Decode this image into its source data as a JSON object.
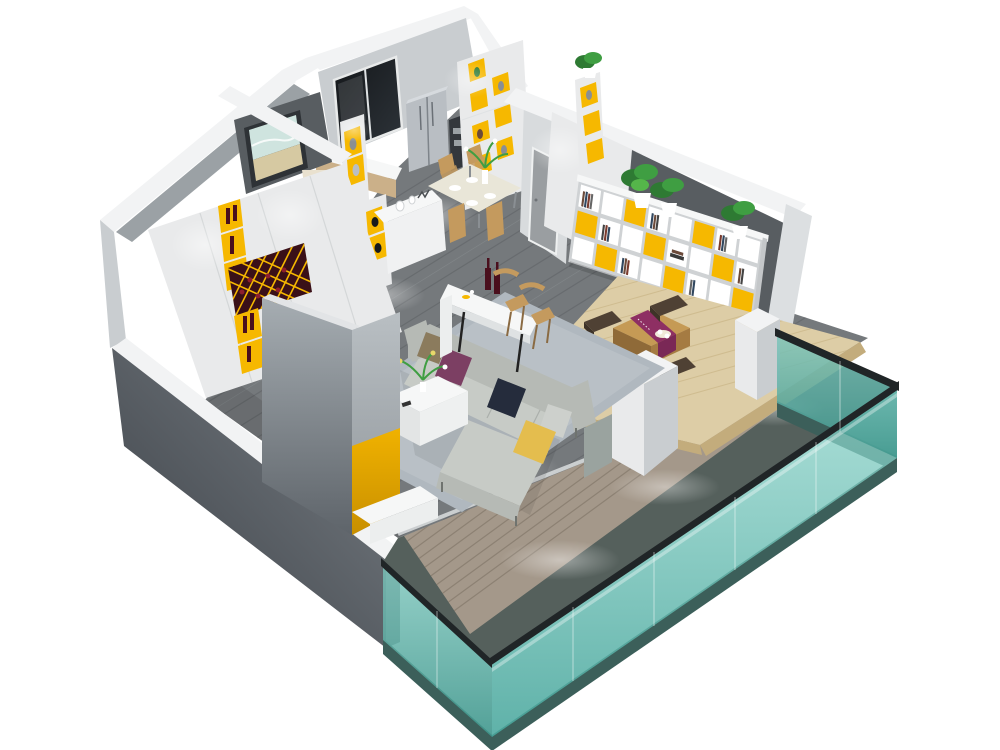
{
  "scene": {
    "description": "isometric-3d-cutaway-render-of-modern-apartment",
    "background": "#ffffff",
    "rooms": [
      {
        "name": "kitchen",
        "items": [
          "dark-glass-window",
          "double-door-refrigerator",
          "oven-column",
          "counter-with-sink",
          "tall-shelf-unit-yellow-niches",
          "display-column-with-plant"
        ]
      },
      {
        "name": "dining-area",
        "items": [
          "dining-table",
          "four-tan-chairs",
          "flower-vase",
          "place-settings"
        ]
      },
      {
        "name": "entry-hall",
        "items": [
          "dark-accent-wall",
          "seascape-wall-art",
          "table-lamp",
          "sideboard-with-wine-slots",
          "display-niche-columns",
          "lit-bottle-shelf",
          "decor-console",
          "hallway-door"
        ]
      },
      {
        "name": "wine-wall",
        "items": [
          "white-panel-cabinet",
          "yellow-bottle-niches",
          "diamond-lattice-wine-rack",
          "spotlights"
        ]
      },
      {
        "name": "living-room",
        "items": [
          "gray-plank-floor",
          "area-rug",
          "l-shaped-sectional-sofa",
          "five-throw-pillows",
          "coffee-table-with-bouquet",
          "tv-partition-wall-yellow-stripe",
          "tv-cabinet",
          "bar-counter",
          "two-bar-stools",
          "two-wine-bottles"
        ]
      },
      {
        "name": "tatami-lounge",
        "items": [
          "raised-wood-platform",
          "low-tea-table",
          "purple-table-runner",
          "four-floor-cushions",
          "tea-set",
          "wall-bookshelf-yellow-panels",
          "three-potted-plants",
          "dark-accent-wall"
        ]
      },
      {
        "name": "balcony",
        "items": [
          "wood-plank-deck",
          "teal-glass-railing",
          "dark-top-rail",
          "stone-base",
          "knee-wall-piers"
        ]
      }
    ],
    "pillow_colors": [
      "taupe",
      "purple",
      "navy",
      "yellow",
      "light-gray"
    ],
    "accent_color_name": "yellow",
    "railing_material": "teal-glass"
  },
  "palette": {
    "bg": "#ffffff",
    "band": "#f2f3f4",
    "white": "#f6f7f7",
    "wallLight": "#e9eaeb",
    "wallMid": "#c9cdd0",
    "wallGray": "#9ba1a5",
    "wallDark": "#585d61",
    "floor": "#75797c",
    "floorLine": "#5d6164",
    "floorLight": "#8b9093",
    "deck": "#a4988a",
    "deckLine": "#7e7264",
    "deckDark": "#55605c",
    "stone": "#3c5f5a",
    "glass": "#7ac9bf",
    "glassDeep": "#3f9a90",
    "rail": "#202527",
    "platform": "#ddcda6",
    "platformEdge": "#c3ac7c",
    "platformLine": "#c9b587",
    "yellow": "#f6b800",
    "yellowDeep": "#c88f00",
    "maroon": "#3a1018",
    "rug": "#b0b8bf",
    "sofa": "#b6bab5",
    "sofaLight": "#c7cbc6",
    "sofaDark": "#979d98",
    "pillowBrown": "#8b7b5d",
    "pillowPurple": "#7c3f63",
    "pillowNavy": "#252c3c",
    "pillowYellow": "#e4bd4e",
    "pillowGray": "#cdd0cc",
    "cushion": "#4f4134",
    "tableWood": "#c59a55",
    "tableWoodDark": "#8f6a38",
    "tableWoodMid": "#a57b42",
    "runner": "#8e2f63",
    "runnerDark": "#7a2856",
    "chairTan": "#c49a5e",
    "bottle": "#4a0f1d",
    "steel": "#b9bec3",
    "doorGray": "#c4c8ca",
    "paintTeal": "#cfe4df",
    "paintSand": "#d6c9a2",
    "lampShade": "#e9e1cf",
    "plant": "#3f9e42",
    "plantDark": "#2e7a33",
    "black": "#17191c"
  }
}
